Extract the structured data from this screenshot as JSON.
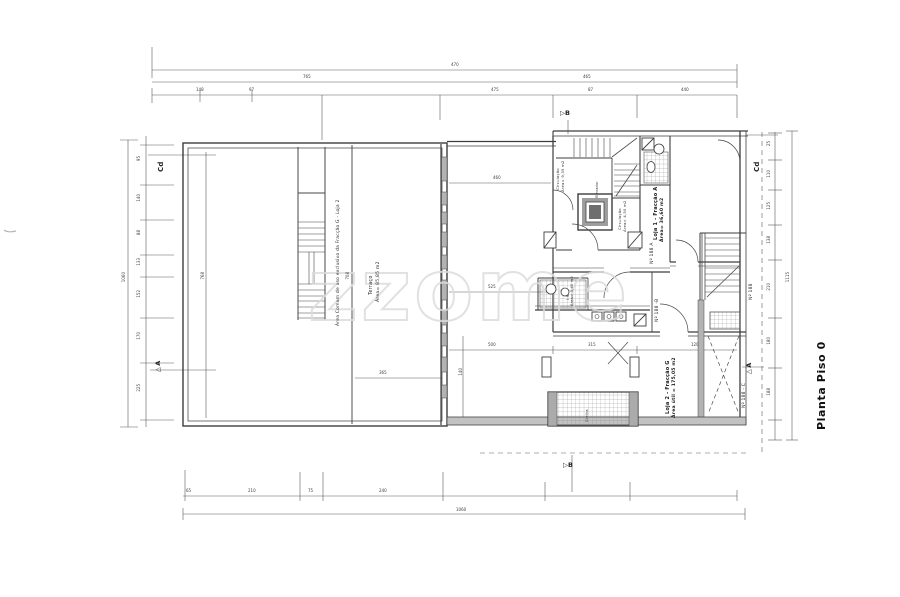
{
  "document": {
    "title": "Planta Piso 0",
    "watermark": "zzome"
  },
  "markers": {
    "cd_left": "Cd",
    "cd_right": "Cd",
    "a_left": "▷A",
    "a_right": "▷A",
    "b_top": "▷B",
    "b_bottom": "▷B"
  },
  "rooms": {
    "common_area": "Área Comum de uso exclusivo da Fracção G - Loja 2",
    "terrace": "Terraço",
    "terrace_area": "Área= 85,85 m2",
    "shop1": "Loja 1 - Fracção A",
    "shop1_area": "Área= 36,60 m2",
    "shop2": "Loja 2 - Fracção G",
    "shop2_area": "Área útil = 175,05 m2",
    "circulation1": "Circulação",
    "circulation1_area": "Área= 9,35 m2",
    "circulation2": "Circulação",
    "circulation2_area": "Área= 4,50 m2",
    "elevator": "Elevador",
    "wc": "I.S.",
    "wc_area": "Área= 3,40 m2",
    "grate": "Grelha",
    "door1": "Nº 188",
    "door2": "Nº 188 A",
    "door3": "Nº 188 -B",
    "door4": "Nº 188 - C"
  },
  "dim_labels": [
    {
      "x": 451,
      "y": 63,
      "v": "470"
    },
    {
      "x": 303,
      "y": 75,
      "v": "765"
    },
    {
      "x": 583,
      "y": 75,
      "v": "465"
    },
    {
      "x": 196,
      "y": 88,
      "v": "148"
    },
    {
      "x": 249,
      "y": 88,
      "v": "97"
    },
    {
      "x": 491,
      "y": 88,
      "v": "475"
    },
    {
      "x": 588,
      "y": 88,
      "v": "87"
    },
    {
      "x": 681,
      "y": 88,
      "v": "440"
    },
    {
      "x": 122,
      "y": 272,
      "v": "1060",
      "rot": 1
    },
    {
      "x": 137,
      "y": 156,
      "v": "95",
      "rot": 1
    },
    {
      "x": 137,
      "y": 194,
      "v": "140",
      "rot": 1
    },
    {
      "x": 137,
      "y": 230,
      "v": "88",
      "rot": 1
    },
    {
      "x": 137,
      "y": 258,
      "v": "133",
      "rot": 1
    },
    {
      "x": 137,
      "y": 290,
      "v": "152",
      "rot": 1
    },
    {
      "x": 137,
      "y": 332,
      "v": "170",
      "rot": 1
    },
    {
      "x": 137,
      "y": 384,
      "v": "225",
      "rot": 1
    },
    {
      "x": 767,
      "y": 141,
      "v": "25",
      "rot": 1
    },
    {
      "x": 767,
      "y": 170,
      "v": "110",
      "rot": 1
    },
    {
      "x": 767,
      "y": 202,
      "v": "125",
      "rot": 1
    },
    {
      "x": 767,
      "y": 236,
      "v": "138",
      "rot": 1
    },
    {
      "x": 767,
      "y": 283,
      "v": "210",
      "rot": 1
    },
    {
      "x": 767,
      "y": 337,
      "v": "180",
      "rot": 1
    },
    {
      "x": 767,
      "y": 388,
      "v": "188",
      "rot": 1
    },
    {
      "x": 786,
      "y": 272,
      "v": "1115",
      "rot": 1
    },
    {
      "x": 186,
      "y": 489,
      "v": "65"
    },
    {
      "x": 248,
      "y": 489,
      "v": "210"
    },
    {
      "x": 308,
      "y": 489,
      "v": "75"
    },
    {
      "x": 379,
      "y": 489,
      "v": "240"
    },
    {
      "x": 456,
      "y": 508,
      "v": "1060"
    },
    {
      "x": 493,
      "y": 176,
      "v": "460"
    },
    {
      "x": 488,
      "y": 285,
      "v": "525"
    },
    {
      "x": 488,
      "y": 343,
      "v": "500"
    },
    {
      "x": 588,
      "y": 343,
      "v": "315"
    },
    {
      "x": 691,
      "y": 343,
      "v": "120"
    },
    {
      "x": 379,
      "y": 371,
      "v": "365"
    },
    {
      "x": 201,
      "y": 272,
      "v": "768",
      "rot": 1
    },
    {
      "x": 346,
      "y": 272,
      "v": "708",
      "rot": 1
    },
    {
      "x": 459,
      "y": 368,
      "v": "140",
      "rot": 1
    }
  ]
}
